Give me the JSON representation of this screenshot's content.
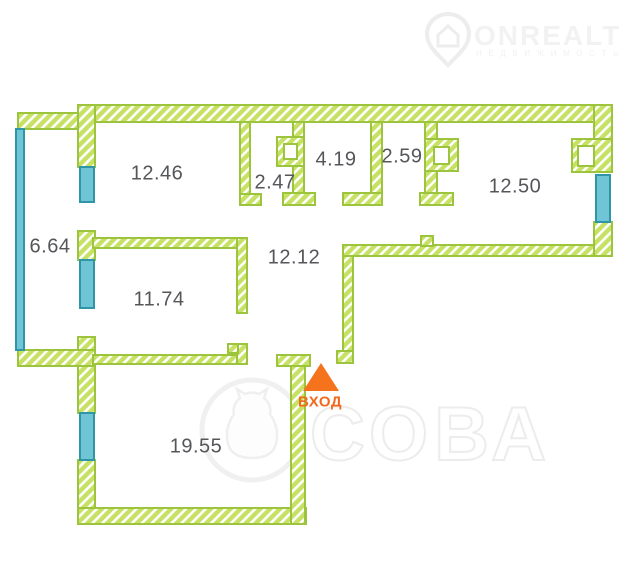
{
  "watermark_logo": {
    "brand": "ONREALT",
    "tagline": "Н Е Д В И Ж И М О С Т Ь",
    "icon": "location-pin-house-icon"
  },
  "floorplan": {
    "rooms": [
      {
        "area": "12.46"
      },
      {
        "area": "2.47"
      },
      {
        "area": "4.19"
      },
      {
        "area": "2.59"
      },
      {
        "area": "12.50"
      },
      {
        "area": "6.64"
      },
      {
        "area": "12.12"
      },
      {
        "area": "11.74"
      },
      {
        "area": "19.55"
      }
    ],
    "entrance": {
      "label": "ВХОД",
      "icon": "entrance-arrow-up-icon"
    },
    "colors": {
      "wall_green": "#c7e164",
      "wall_border": "#9cc43c",
      "window_blue": "#6fc4d6",
      "window_border": "#2f96a8",
      "entrance_orange": "#f2691c",
      "label_text": "#54565a",
      "watermark_gray": "#efefef"
    }
  },
  "watermark_center": {
    "text": "СОВА",
    "icon": "owl-in-circle-icon"
  }
}
